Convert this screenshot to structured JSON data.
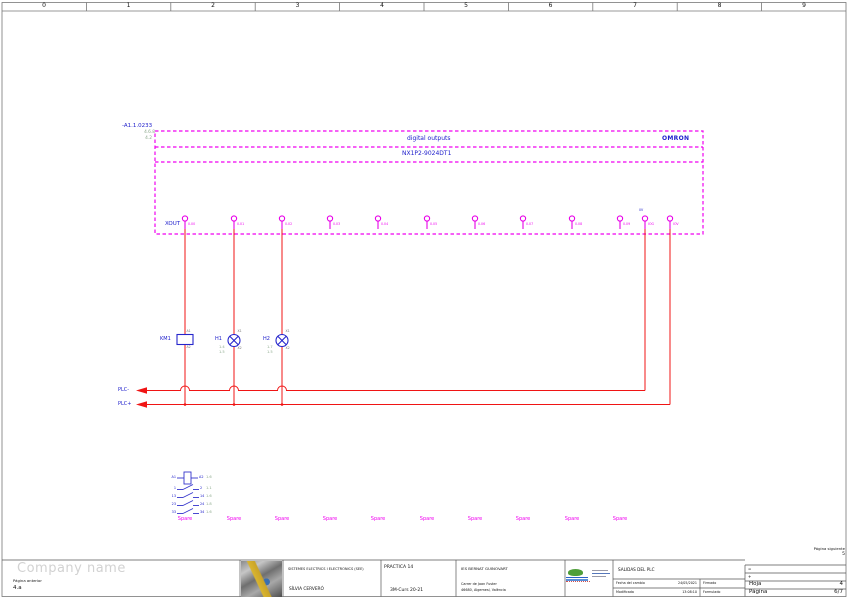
{
  "page": {
    "ruler_numbers": [
      "0",
      "1",
      "2",
      "3",
      "4",
      "5",
      "6",
      "7",
      "8",
      "9"
    ],
    "company_name": "Company name",
    "prev_page_label": "Página anterior",
    "prev_page_value": "4.a",
    "next_page_label": "Página siguiente",
    "next_page_value": "5"
  },
  "module": {
    "tag": "-A1.1.0233",
    "refs": [
      "4.6.8",
      "4.2"
    ],
    "title": "digital outputs",
    "brand": "OMRON",
    "model": "NX1P2-9024DT1",
    "connector": "XOUT",
    "terminals": [
      "0.00",
      "0.01",
      "0.02",
      "0.03",
      "0.04",
      "0.05",
      "0.06",
      "0.07",
      "0.08",
      "0.09",
      "IOG",
      "IOV"
    ],
    "common_sublabel": "0V"
  },
  "components": {
    "km1": {
      "name": "KM1",
      "t_top": "A1",
      "t_bottom": "A2"
    },
    "h1": {
      "name": "H1",
      "t_top": "X1",
      "t_bottom": "X2",
      "refs": [
        "1.4",
        "1.5"
      ]
    },
    "h2": {
      "name": "H2",
      "t_top": "X1",
      "t_bottom": "X2",
      "refs": [
        "1.7",
        "1.5"
      ]
    }
  },
  "rails": {
    "minus": "PLC-",
    "plus": "PLC+"
  },
  "legend": {
    "coil": {
      "left": "A1",
      "right": "A2",
      "ref": "1.6"
    },
    "contacts": [
      {
        "left": "1",
        "right": "2",
        "ref": "1.1"
      },
      {
        "left": "13",
        "right": "14",
        "ref": "1.6"
      },
      {
        "left": "23",
        "right": "24",
        "ref": "1.8"
      },
      {
        "left": "33",
        "right": "34",
        "ref": "1.6"
      }
    ],
    "spare_label": "Spare"
  },
  "titleblock": {
    "dept": "SISTEMES ELECTRICS I ELECTRONICS (SEE)",
    "author": "SÍLVIA CERVERÓ",
    "practice": "PRACTICA 14",
    "course": "3M-Curs 20-21",
    "school": "IES BERNAT GUINOVART",
    "address1": "Carrer de Joan Fuster",
    "address2": "46680, Algemesí, València",
    "sheet_title": "SALIDAS DEL PLC",
    "date_label": "Fecha del cambio",
    "date_value": "24/05/2021",
    "signed_label": "Firmado",
    "modified_label": "Modificada",
    "modified_value": "13:08:10",
    "form_label": "Formulado",
    "eq_label": "=",
    "plus_label": "+",
    "sheet_label": "Hoja",
    "sheet_value": "4",
    "pagenum_label": "Página",
    "pagenum_value": "6/7"
  },
  "colors": {
    "wire": "#f01414",
    "module_outline": "#f000f0",
    "symbol": "#2020cc",
    "cross_ref": "#8aa88a"
  }
}
